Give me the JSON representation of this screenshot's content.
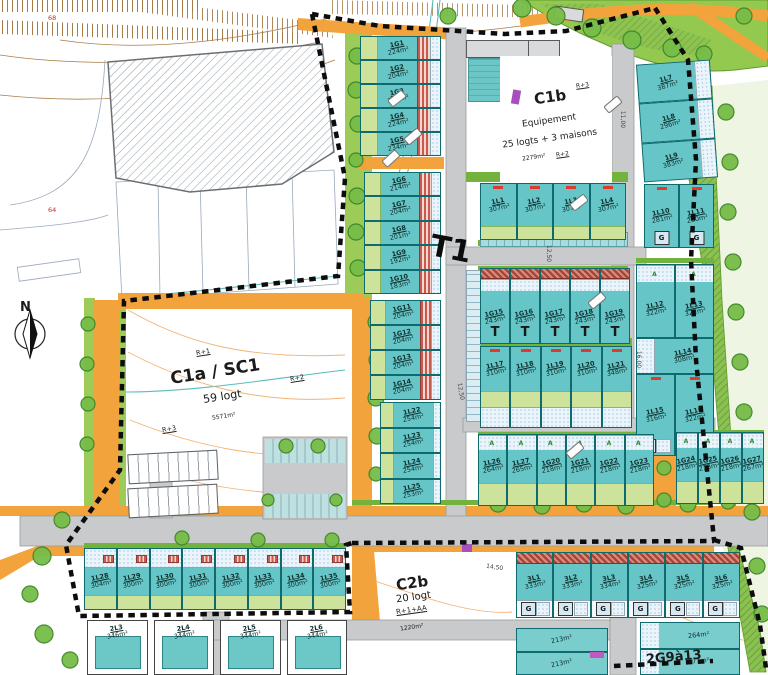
{
  "symbols": {
    "north": "N",
    "t1": "T1",
    "garage": "G",
    "a_mark": "A"
  },
  "zones": {
    "c1a": {
      "name": "C1a / SC1",
      "units": "59 logt",
      "area": "5571m²",
      "fl_top": "R+1",
      "fl_right": "R+2",
      "fl_bottom": "R+3"
    },
    "c1b": {
      "name": "C1b",
      "fl": "R+3",
      "line1": "Equipement",
      "line2": "25 logts + 3 maisons",
      "area": "2279m²",
      "fl2": "R+2"
    },
    "c2b": {
      "name": "C2b",
      "units": "20 logt",
      "fl": "R+1+AA",
      "area": "1220m²"
    },
    "g2": {
      "name": "2G9à13"
    }
  },
  "dims": {
    "d11": "11,00",
    "d125a": "12,50",
    "d125b": "12,50",
    "d16": "16,00",
    "d145": "14,50"
  },
  "contour_labels": {
    "a": "68",
    "b": "64"
  },
  "lots": {
    "west_g_a": [
      {
        "id": "1G1",
        "area": "224m²"
      },
      {
        "id": "1G2",
        "area": "204m²"
      },
      {
        "id": "1G3",
        "area": "214m²"
      },
      {
        "id": "1G4",
        "area": "224m²"
      },
      {
        "id": "1G5",
        "area": "234m²"
      }
    ],
    "west_g_b": [
      {
        "id": "1G6",
        "area": "214m²"
      },
      {
        "id": "1G7",
        "area": "204m²"
      },
      {
        "id": "1G8",
        "area": "201m²"
      },
      {
        "id": "1G9",
        "area": "192m²"
      },
      {
        "id": "1G10",
        "area": "183m²"
      }
    ],
    "west_g_c": [
      {
        "id": "1G11",
        "area": "204m²"
      },
      {
        "id": "1G12",
        "area": "204m²"
      },
      {
        "id": "1G13",
        "area": "204m²"
      },
      {
        "id": "1G14",
        "area": "204m²"
      }
    ],
    "west_l": [
      {
        "id": "1L22",
        "area": "254m²"
      },
      {
        "id": "1L23",
        "area": "254m²"
      },
      {
        "id": "1L24",
        "area": "254m²"
      },
      {
        "id": "1L25",
        "area": "253m²"
      }
    ],
    "row307": [
      {
        "id": "1L1",
        "area": "307m²"
      },
      {
        "id": "1L2",
        "area": "307m²"
      },
      {
        "id": "1L3",
        "area": "307m²"
      },
      {
        "id": "1L4",
        "area": "307m²"
      }
    ],
    "east_edge": [
      {
        "id": "1L7",
        "area": "387m²"
      },
      {
        "id": "1L8",
        "area": "296m²"
      },
      {
        "id": "1L9",
        "area": "383m²"
      }
    ],
    "east_pair": [
      {
        "id": "1L10",
        "area": "281m²"
      },
      {
        "id": "1L11",
        "area": "280m²"
      }
    ],
    "g_row": [
      {
        "id": "1G15",
        "area": "243m²"
      },
      {
        "id": "1G16",
        "area": "243m²"
      },
      {
        "id": "1G17",
        "area": "243m²"
      },
      {
        "id": "1G18",
        "area": "243m²"
      },
      {
        "id": "1G19",
        "area": "243m²"
      }
    ],
    "l_row": [
      {
        "id": "1L17",
        "area": "310m²"
      },
      {
        "id": "1L18",
        "area": "310m²"
      },
      {
        "id": "1L19",
        "area": "310m²"
      },
      {
        "id": "1L20",
        "area": "310m²"
      },
      {
        "id": "1L21",
        "area": "348m²"
      }
    ],
    "east_col_top": [
      {
        "id": "1L12",
        "area": "322m²"
      },
      {
        "id": "1L13",
        "area": "322m²"
      }
    ],
    "east_col_mid": [
      {
        "id": "1L14",
        "area": "308m²"
      }
    ],
    "east_col_bot": [
      {
        "id": "1L15",
        "area": "316m²"
      },
      {
        "id": "1L16",
        "area": "322m²"
      }
    ],
    "south_a": [
      {
        "id": "1L26",
        "area": "264m²"
      },
      {
        "id": "1L27",
        "area": "265m²"
      },
      {
        "id": "1G20",
        "area": "218m²"
      },
      {
        "id": "1G21",
        "area": "218m²"
      },
      {
        "id": "1G22",
        "area": "218m²"
      },
      {
        "id": "1G23",
        "area": "218m²"
      }
    ],
    "south_b": [
      {
        "id": "1G24",
        "area": "218m²"
      },
      {
        "id": "1G25",
        "area": "218m²"
      },
      {
        "id": "1G26",
        "area": "218m²"
      },
      {
        "id": "1G27",
        "area": "267m²"
      }
    ],
    "sw_strip": [
      {
        "id": "1L28",
        "area": "304m²"
      },
      {
        "id": "1L29",
        "area": "300m²"
      },
      {
        "id": "1L30",
        "area": "300m²"
      },
      {
        "id": "1L31",
        "area": "300m²"
      },
      {
        "id": "1L32",
        "area": "300m²"
      },
      {
        "id": "1L33",
        "area": "300m²"
      },
      {
        "id": "1L34",
        "area": "300m²"
      },
      {
        "id": "1L35",
        "area": "300m²"
      }
    ],
    "strip_3l": [
      {
        "id": "3L1",
        "area": "333m²"
      },
      {
        "id": "3L2",
        "area": "333m²"
      },
      {
        "id": "3L3",
        "area": "334m²"
      },
      {
        "id": "3L4",
        "area": "325m²"
      },
      {
        "id": "3L5",
        "area": "325m²"
      },
      {
        "id": "3L6",
        "area": "325m²"
      }
    ],
    "row_2l": [
      {
        "id": "2L3",
        "area": "346m²"
      },
      {
        "id": "2L4",
        "area": "344m²"
      },
      {
        "id": "2L5",
        "area": "344m²"
      },
      {
        "id": "2L6",
        "area": "344m²"
      }
    ],
    "se_left": [
      {
        "area": "213m²"
      },
      {
        "area": "213m²"
      }
    ],
    "se_right": [
      {
        "area": "264m²"
      },
      {
        "area": "371m²"
      }
    ]
  }
}
